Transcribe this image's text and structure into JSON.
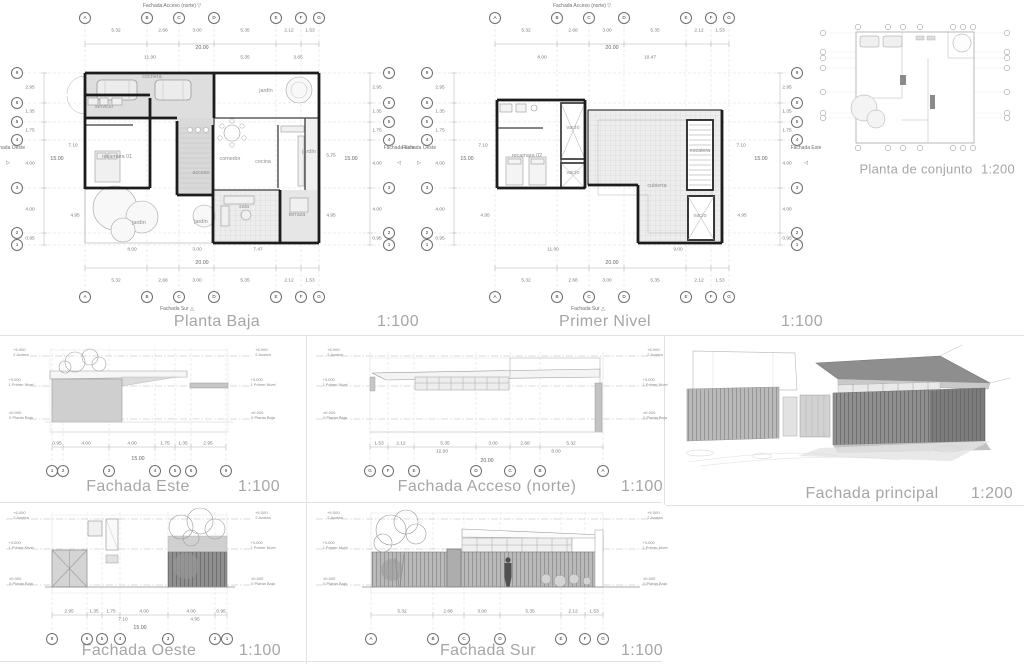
{
  "colors": {
    "ink": "#1c1c1c",
    "muted_title": "#a6a6a6",
    "fill_light": "#dedede",
    "fill_tile": "#ededed"
  },
  "panels": {
    "planta_baja": {
      "title": "Planta Baja",
      "scale": "1:100"
    },
    "primer_nivel": {
      "title": "Primer Nivel",
      "scale": "1:100"
    },
    "planta_conjunto": {
      "title": "Planta de conjunto",
      "scale": "1:200"
    },
    "fachada_este": {
      "title": "Fachada Este",
      "scale": "1:100"
    },
    "fachada_acceso": {
      "title": "Fachada Acceso (norte)",
      "scale": "1:100"
    },
    "fachada_principal": {
      "title": "Fachada principal",
      "scale": "1:200"
    },
    "fachada_oeste": {
      "title": "Fachada Oeste",
      "scale": "1:100"
    },
    "fachada_sur": {
      "title": "Fachada Sur",
      "scale": "1:100"
    }
  },
  "annotations": {
    "bubbles": [
      {
        "t": "A",
        "x": 85,
        "y": 18
      },
      {
        "t": "B",
        "x": 147,
        "y": 18
      },
      {
        "t": "C",
        "x": 179,
        "y": 18
      },
      {
        "t": "D",
        "x": 214,
        "y": 18
      },
      {
        "t": "E",
        "x": 276,
        "y": 18
      },
      {
        "t": "F",
        "x": 301,
        "y": 18
      },
      {
        "t": "G",
        "x": 319,
        "y": 18
      },
      {
        "t": "A",
        "x": 85,
        "y": 297
      },
      {
        "t": "B",
        "x": 147,
        "y": 297
      },
      {
        "t": "C",
        "x": 179,
        "y": 297
      },
      {
        "t": "D",
        "x": 214,
        "y": 297
      },
      {
        "t": "E",
        "x": 276,
        "y": 297
      },
      {
        "t": "F",
        "x": 301,
        "y": 297
      },
      {
        "t": "G",
        "x": 319,
        "y": 297
      },
      {
        "t": "9",
        "x": 17,
        "y": 73
      },
      {
        "t": "6",
        "x": 17,
        "y": 103
      },
      {
        "t": "5",
        "x": 17,
        "y": 122
      },
      {
        "t": "4",
        "x": 17,
        "y": 140
      },
      {
        "t": "3",
        "x": 17,
        "y": 188
      },
      {
        "t": "2",
        "x": 17,
        "y": 233
      },
      {
        "t": "1",
        "x": 17,
        "y": 245
      },
      {
        "t": "9",
        "x": 389,
        "y": 73
      },
      {
        "t": "6",
        "x": 389,
        "y": 103
      },
      {
        "t": "5",
        "x": 389,
        "y": 122
      },
      {
        "t": "4",
        "x": 389,
        "y": 140
      },
      {
        "t": "3",
        "x": 389,
        "y": 188
      },
      {
        "t": "2",
        "x": 389,
        "y": 233
      },
      {
        "t": "1",
        "x": 389,
        "y": 245
      },
      {
        "t": "A",
        "x": 495,
        "y": 18
      },
      {
        "t": "B",
        "x": 557,
        "y": 18
      },
      {
        "t": "C",
        "x": 589,
        "y": 18
      },
      {
        "t": "D",
        "x": 624,
        "y": 18
      },
      {
        "t": "E",
        "x": 686,
        "y": 18
      },
      {
        "t": "F",
        "x": 711,
        "y": 18
      },
      {
        "t": "G",
        "x": 729,
        "y": 18
      },
      {
        "t": "A",
        "x": 495,
        "y": 297
      },
      {
        "t": "B",
        "x": 557,
        "y": 297
      },
      {
        "t": "C",
        "x": 589,
        "y": 297
      },
      {
        "t": "D",
        "x": 624,
        "y": 297
      },
      {
        "t": "E",
        "x": 686,
        "y": 297
      },
      {
        "t": "F",
        "x": 711,
        "y": 297
      },
      {
        "t": "G",
        "x": 729,
        "y": 297
      },
      {
        "t": "9",
        "x": 427,
        "y": 73
      },
      {
        "t": "6",
        "x": 427,
        "y": 103
      },
      {
        "t": "5",
        "x": 427,
        "y": 122
      },
      {
        "t": "4",
        "x": 427,
        "y": 140
      },
      {
        "t": "3",
        "x": 427,
        "y": 188
      },
      {
        "t": "2",
        "x": 427,
        "y": 233
      },
      {
        "t": "1",
        "x": 427,
        "y": 245
      },
      {
        "t": "9",
        "x": 797,
        "y": 73
      },
      {
        "t": "6",
        "x": 797,
        "y": 103
      },
      {
        "t": "5",
        "x": 797,
        "y": 122
      },
      {
        "t": "4",
        "x": 797,
        "y": 140
      },
      {
        "t": "3",
        "x": 797,
        "y": 188
      },
      {
        "t": "2",
        "x": 797,
        "y": 233
      },
      {
        "t": "1",
        "x": 797,
        "y": 245
      },
      {
        "t": "1",
        "x": 52,
        "y": 471
      },
      {
        "t": "2",
        "x": 63,
        "y": 471
      },
      {
        "t": "3",
        "x": 109,
        "y": 471
      },
      {
        "t": "4",
        "x": 155,
        "y": 471
      },
      {
        "t": "5",
        "x": 175,
        "y": 471
      },
      {
        "t": "6",
        "x": 191,
        "y": 471
      },
      {
        "t": "9",
        "x": 226,
        "y": 471
      },
      {
        "t": "G",
        "x": 370,
        "y": 471
      },
      {
        "t": "F",
        "x": 388,
        "y": 471
      },
      {
        "t": "E",
        "x": 414,
        "y": 471
      },
      {
        "t": "D",
        "x": 476,
        "y": 471
      },
      {
        "t": "C",
        "x": 510,
        "y": 471
      },
      {
        "t": "B",
        "x": 540,
        "y": 471
      },
      {
        "t": "A",
        "x": 603,
        "y": 471
      },
      {
        "t": "9",
        "x": 52,
        "y": 639
      },
      {
        "t": "6",
        "x": 87,
        "y": 639
      },
      {
        "t": "5",
        "x": 102,
        "y": 639
      },
      {
        "t": "4",
        "x": 120,
        "y": 639
      },
      {
        "t": "3",
        "x": 168,
        "y": 639
      },
      {
        "t": "2",
        "x": 215,
        "y": 639
      },
      {
        "t": "1",
        "x": 227,
        "y": 639
      },
      {
        "t": "A",
        "x": 371,
        "y": 639
      },
      {
        "t": "B",
        "x": 433,
        "y": 639
      },
      {
        "t": "C",
        "x": 464,
        "y": 639
      },
      {
        "t": "D",
        "x": 500,
        "y": 639
      },
      {
        "t": "E",
        "x": 561,
        "y": 639
      },
      {
        "t": "F",
        "x": 585,
        "y": 639
      },
      {
        "t": "G",
        "x": 603,
        "y": 639
      }
    ],
    "dims": [
      {
        "t": "5.32",
        "x": 116,
        "y": 31
      },
      {
        "t": "2.68",
        "x": 163,
        "y": 31
      },
      {
        "t": "3.00",
        "x": 197,
        "y": 31
      },
      {
        "t": "5.35",
        "x": 245,
        "y": 31
      },
      {
        "t": "2.12",
        "x": 289,
        "y": 31
      },
      {
        "t": "1.53",
        "x": 310,
        "y": 31
      },
      {
        "t": "11.00",
        "x": 150,
        "y": 58
      },
      {
        "t": "5.35",
        "x": 245,
        "y": 58
      },
      {
        "t": "3.65",
        "x": 298,
        "y": 58
      },
      {
        "t": "8.00",
        "x": 132,
        "y": 250
      },
      {
        "t": "3.00",
        "x": 197,
        "y": 250
      },
      {
        "t": "7.47",
        "x": 258,
        "y": 250
      },
      {
        "t": "5.32",
        "x": 116,
        "y": 281
      },
      {
        "t": "2.68",
        "x": 163,
        "y": 281
      },
      {
        "t": "3.00",
        "x": 197,
        "y": 281
      },
      {
        "t": "5.35",
        "x": 245,
        "y": 281
      },
      {
        "t": "2.12",
        "x": 289,
        "y": 281
      },
      {
        "t": "1.53",
        "x": 310,
        "y": 281
      },
      {
        "t": "2.95",
        "x": 30,
        "y": 88
      },
      {
        "t": "1.35",
        "x": 30,
        "y": 112
      },
      {
        "t": "1.75",
        "x": 30,
        "y": 131
      },
      {
        "t": "4.00",
        "x": 30,
        "y": 164
      },
      {
        "t": "4.00",
        "x": 30,
        "y": 210
      },
      {
        "t": "0.95",
        "x": 30,
        "y": 239
      },
      {
        "t": "7.10",
        "x": 73,
        "y": 146
      },
      {
        "t": "4.95",
        "x": 75,
        "y": 216
      },
      {
        "t": "2.95",
        "x": 377,
        "y": 88
      },
      {
        "t": "1.35",
        "x": 377,
        "y": 112
      },
      {
        "t": "1.75",
        "x": 377,
        "y": 131
      },
      {
        "t": "4.00",
        "x": 377,
        "y": 164
      },
      {
        "t": "4.00",
        "x": 377,
        "y": 210
      },
      {
        "t": "0.95",
        "x": 377,
        "y": 239
      },
      {
        "t": "5.75",
        "x": 331,
        "y": 156
      },
      {
        "t": "4.95",
        "x": 331,
        "y": 216
      },
      {
        "t": "5.32",
        "x": 526,
        "y": 31
      },
      {
        "t": "2.68",
        "x": 573,
        "y": 31
      },
      {
        "t": "3.00",
        "x": 607,
        "y": 31
      },
      {
        "t": "5.35",
        "x": 655,
        "y": 31
      },
      {
        "t": "2.12",
        "x": 699,
        "y": 31
      },
      {
        "t": "1.53",
        "x": 720,
        "y": 31
      },
      {
        "t": "8.00",
        "x": 542,
        "y": 58
      },
      {
        "t": "10.47",
        "x": 650,
        "y": 58
      },
      {
        "t": "11.00",
        "x": 553,
        "y": 250
      },
      {
        "t": "9.00",
        "x": 678,
        "y": 250
      },
      {
        "t": "5.32",
        "x": 526,
        "y": 281
      },
      {
        "t": "2.68",
        "x": 573,
        "y": 281
      },
      {
        "t": "3.00",
        "x": 607,
        "y": 281
      },
      {
        "t": "5.35",
        "x": 655,
        "y": 281
      },
      {
        "t": "2.12",
        "x": 699,
        "y": 281
      },
      {
        "t": "1.53",
        "x": 720,
        "y": 281
      },
      {
        "t": "2.95",
        "x": 440,
        "y": 88
      },
      {
        "t": "1.35",
        "x": 440,
        "y": 112
      },
      {
        "t": "1.75",
        "x": 440,
        "y": 131
      },
      {
        "t": "4.00",
        "x": 440,
        "y": 164
      },
      {
        "t": "4.00",
        "x": 440,
        "y": 210
      },
      {
        "t": "0.95",
        "x": 440,
        "y": 239
      },
      {
        "t": "7.10",
        "x": 483,
        "y": 146
      },
      {
        "t": "4.95",
        "x": 485,
        "y": 216
      },
      {
        "t": "2.95",
        "x": 787,
        "y": 88
      },
      {
        "t": "1.35",
        "x": 787,
        "y": 112
      },
      {
        "t": "1.75",
        "x": 787,
        "y": 131
      },
      {
        "t": "4.00",
        "x": 787,
        "y": 164
      },
      {
        "t": "4.00",
        "x": 787,
        "y": 210
      },
      {
        "t": "0.95",
        "x": 787,
        "y": 239
      },
      {
        "t": "7.10",
        "x": 741,
        "y": 146
      },
      {
        "t": "4.95",
        "x": 742,
        "y": 216
      },
      {
        "t": "0.95",
        "x": 57,
        "y": 444
      },
      {
        "t": "4.00",
        "x": 86,
        "y": 444
      },
      {
        "t": "4.00",
        "x": 132,
        "y": 444
      },
      {
        "t": "1.75",
        "x": 165,
        "y": 444
      },
      {
        "t": "1.35",
        "x": 183,
        "y": 444
      },
      {
        "t": "2.95",
        "x": 208,
        "y": 444
      },
      {
        "t": "1.53",
        "x": 379,
        "y": 444
      },
      {
        "t": "2.12",
        "x": 401,
        "y": 444
      },
      {
        "t": "5.35",
        "x": 445,
        "y": 444
      },
      {
        "t": "3.00",
        "x": 493,
        "y": 444
      },
      {
        "t": "2.68",
        "x": 525,
        "y": 444
      },
      {
        "t": "5.32",
        "x": 571,
        "y": 444
      },
      {
        "t": "12.00",
        "x": 442,
        "y": 452
      },
      {
        "t": "8.00",
        "x": 556,
        "y": 452
      },
      {
        "t": "2.95",
        "x": 69,
        "y": 612
      },
      {
        "t": "1.35",
        "x": 94,
        "y": 612
      },
      {
        "t": "1.75",
        "x": 111,
        "y": 612
      },
      {
        "t": "4.00",
        "x": 144,
        "y": 612
      },
      {
        "t": "4.00",
        "x": 191,
        "y": 612
      },
      {
        "t": "0.95",
        "x": 221,
        "y": 612
      },
      {
        "t": "7.10",
        "x": 123,
        "y": 620
      },
      {
        "t": "4.95",
        "x": 195,
        "y": 620
      },
      {
        "t": "5.32",
        "x": 402,
        "y": 612
      },
      {
        "t": "2.68",
        "x": 448,
        "y": 612
      },
      {
        "t": "3.00",
        "x": 482,
        "y": 612
      },
      {
        "t": "5.35",
        "x": 530,
        "y": 612
      },
      {
        "t": "2.12",
        "x": 573,
        "y": 612
      },
      {
        "t": "1.53",
        "x": 594,
        "y": 612
      }
    ],
    "dim_totals": [
      {
        "t": "20.00",
        "x": 202,
        "y": 48
      },
      {
        "t": "20.00",
        "x": 202,
        "y": 263
      },
      {
        "t": "15.00",
        "x": 57,
        "y": 159
      },
      {
        "t": "15.00",
        "x": 351,
        "y": 159
      },
      {
        "t": "20.00",
        "x": 612,
        "y": 48
      },
      {
        "t": "20.00",
        "x": 612,
        "y": 263
      },
      {
        "t": "15.00",
        "x": 467,
        "y": 159
      },
      {
        "t": "15.00",
        "x": 761,
        "y": 159
      },
      {
        "t": "15.00",
        "x": 138,
        "y": 459
      },
      {
        "t": "20.00",
        "x": 487,
        "y": 461
      },
      {
        "t": "15.00",
        "x": 140,
        "y": 628
      }
    ],
    "rooms": [
      {
        "t": "cochera",
        "x": 152,
        "y": 77
      },
      {
        "t": "jardín",
        "x": 266,
        "y": 91
      },
      {
        "t": "servicio",
        "x": 104,
        "y": 107
      },
      {
        "t": "recamara 01",
        "x": 117,
        "y": 157
      },
      {
        "t": "acceso",
        "x": 201,
        "y": 173
      },
      {
        "t": "comedor",
        "x": 230,
        "y": 159
      },
      {
        "t": "cocina",
        "x": 263,
        "y": 162
      },
      {
        "t": "jardín",
        "x": 309,
        "y": 152
      },
      {
        "t": "sala",
        "x": 244,
        "y": 207
      },
      {
        "t": "terraza",
        "x": 297,
        "y": 215
      },
      {
        "t": "jardín",
        "x": 139,
        "y": 223
      },
      {
        "t": "jardín",
        "x": 201,
        "y": 222
      },
      {
        "t": "recamara 02",
        "x": 527,
        "y": 156
      },
      {
        "t": "vacío",
        "x": 573,
        "y": 128
      },
      {
        "t": "vacío",
        "x": 573,
        "y": 173
      },
      {
        "t": "cubierta",
        "x": 657,
        "y": 186
      },
      {
        "t": "escalera",
        "x": 700,
        "y": 151
      },
      {
        "t": "vacío",
        "x": 700,
        "y": 216
      }
    ],
    "markers_h": [
      {
        "t": "Fachada Acceso (norte)  ▽",
        "x": 172,
        "y": 6
      },
      {
        "t": "Fachada Sur  △",
        "x": 177,
        "y": 309
      },
      {
        "t": "Fachada Acceso (norte)  ▽",
        "x": 582,
        "y": 6
      },
      {
        "t": "Fachada Sur  △",
        "x": 588,
        "y": 309
      },
      {
        "t": "▷",
        "x": 8,
        "y": 163
      },
      {
        "t": "◁",
        "x": 399,
        "y": 163
      },
      {
        "t": "▷",
        "x": 419,
        "y": 163
      },
      {
        "t": "◁",
        "x": 806,
        "y": 163
      }
    ],
    "markers_v": [
      {
        "t": "Fachada Oeste",
        "x": 8,
        "y": 148
      },
      {
        "t": "Fachada Este",
        "x": 399,
        "y": 148
      },
      {
        "t": "Fachada Oeste",
        "x": 419,
        "y": 148
      },
      {
        "t": "Fachada Este",
        "x": 806,
        "y": 148
      }
    ],
    "levels": [
      {
        "v": "+6.000",
        "n": "2 Azotea",
        "x": 21,
        "y": 352
      },
      {
        "v": "+3.000",
        "n": "1 Primer Nivel",
        "x": 21,
        "y": 382
      },
      {
        "v": "±0.000",
        "n": "0 Planta Baja",
        "x": 21,
        "y": 415
      },
      {
        "v": "+6.000",
        "n": "2 Azotea",
        "x": 263,
        "y": 352
      },
      {
        "v": "+3.000",
        "n": "1 Primer Nivel",
        "x": 263,
        "y": 382
      },
      {
        "v": "±0.000",
        "n": "0 Planta Baja",
        "x": 263,
        "y": 415
      },
      {
        "v": "+6.000",
        "n": "2 Azotea",
        "x": 335,
        "y": 352
      },
      {
        "v": "+3.000",
        "n": "1 Primer Nivel",
        "x": 335,
        "y": 382
      },
      {
        "v": "±0.000",
        "n": "0 Planta Baja",
        "x": 335,
        "y": 415
      },
      {
        "v": "+6.000",
        "n": "2 Azotea",
        "x": 655,
        "y": 352
      },
      {
        "v": "+3.000",
        "n": "1 Primer Nivel",
        "x": 655,
        "y": 382
      },
      {
        "v": "±0.000",
        "n": "0 Planta Baja",
        "x": 655,
        "y": 415
      },
      {
        "v": "+6.000",
        "n": "2 Azotea",
        "x": 21,
        "y": 515
      },
      {
        "v": "+3.000",
        "n": "1 Primer Nivel",
        "x": 21,
        "y": 545
      },
      {
        "v": "±0.000",
        "n": "0 Planta Baja",
        "x": 21,
        "y": 581
      },
      {
        "v": "+6.000",
        "n": "2 Azotea",
        "x": 263,
        "y": 515
      },
      {
        "v": "+3.000",
        "n": "1 Primer Nivel",
        "x": 263,
        "y": 545
      },
      {
        "v": "±0.000",
        "n": "0 Planta Baja",
        "x": 263,
        "y": 581
      },
      {
        "v": "+6.000",
        "n": "2 Azotea",
        "x": 335,
        "y": 515
      },
      {
        "v": "+3.000",
        "n": "1 Primer Nivel",
        "x": 335,
        "y": 545
      },
      {
        "v": "±0.000",
        "n": "0 Planta Baja",
        "x": 335,
        "y": 581
      },
      {
        "v": "+6.000",
        "n": "2 Azotea",
        "x": 655,
        "y": 515
      },
      {
        "v": "+3.000",
        "n": "1 Primer Nivel",
        "x": 655,
        "y": 545
      },
      {
        "v": "±0.000",
        "n": "0 Planta Baja",
        "x": 655,
        "y": 581
      }
    ]
  }
}
